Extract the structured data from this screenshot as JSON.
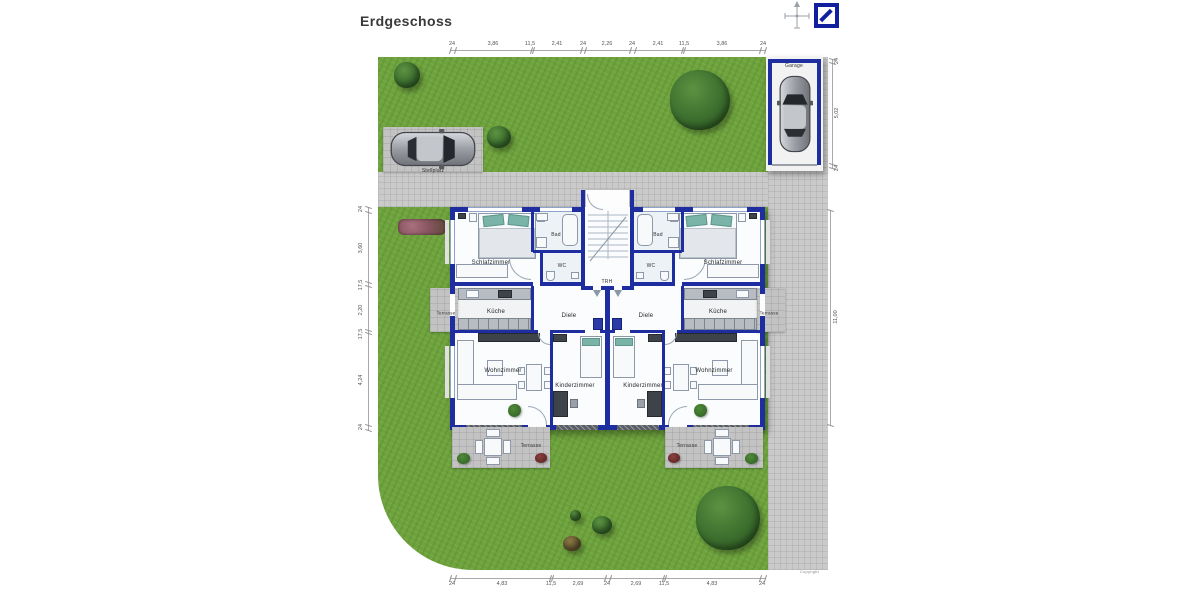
{
  "title": "Erdgeschoss",
  "site": {
    "stellplatz": "Stellplatz",
    "garage": "Garage",
    "copyright": "Copyright"
  },
  "rooms": {
    "trh": "TRH",
    "left": {
      "schlafzimmer": "Schlafzimmer",
      "bad": "Bad",
      "wc": "WC",
      "kueche": "Küche",
      "diele": "Diele",
      "wohnzimmer": "Wohnzimmer",
      "kinderzimmer": "Kinderzimmer",
      "terrasse_seite": "Terrasse",
      "terrasse_garten": "Terrasse"
    },
    "right": {
      "schlafzimmer": "Schlafzimmer",
      "bad": "Bad",
      "wc": "WC",
      "kueche": "Küche",
      "diele": "Diele",
      "wohnzimmer": "Wohnzimmer",
      "kinderzimmer": "Kinderzimmer",
      "terrasse_seite": "Terrasse",
      "terrasse_garten": "Terrasse"
    }
  },
  "dims": {
    "top": [
      "24",
      "3,86",
      "11,5",
      "2,41",
      "24",
      "2,26",
      "24",
      "2,41",
      "11,5",
      "3,86",
      "24"
    ],
    "bottom": [
      "24",
      "4,83",
      "11,5",
      "2,69",
      "24",
      "2,69",
      "11,5",
      "4,83",
      "24"
    ],
    "left": [
      "24",
      "3,60",
      "17,5",
      "2,20",
      "17,5",
      "4,24",
      "24"
    ],
    "right_building": "11,00",
    "garage": [
      "24",
      "5,02",
      "24"
    ]
  },
  "colors": {
    "wall_blue": "#1e2da0",
    "grass_green": "#6ea33d",
    "path_gray": "#cacaca",
    "logo_blue": "#101f9e",
    "pillow_teal": "#7ab3a8"
  }
}
